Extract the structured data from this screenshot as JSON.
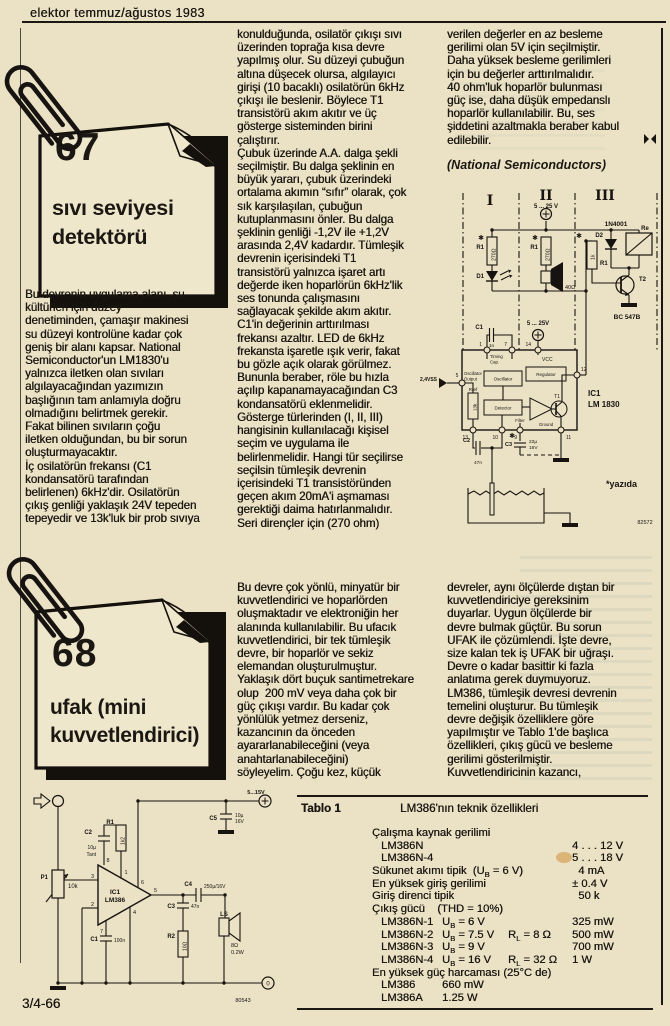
{
  "header": {
    "title": "elektor temmuz/ağustos 1983"
  },
  "footer": {
    "page_number": "3/4-66"
  },
  "article67": {
    "number": "67",
    "title": "sıvı seviyesi\ndetektörü",
    "col1": "Bu devrenin uygulama alanı, su\nkültürleri için düzey\ndenetiminden, çamaşır makinesi\nsu düzeyi kontrolüne kadar çok\ngeniş bir alanı kapsar. National\nSemiconductor'un LM1830'u\nyalnızca iletken olan sıvıları\nalgılayacağından yazımızın\nbaşlığının tam anlamıyla doğru\nolmadığını belirtmek gerekir.\nFakat bilinen sıvıların çoğu\niletken olduğundan, bu bir sorun\noluşturmayacaktır.\nİç osilatörün frekansı (C1\nkondansatörü tarafından\nbelirlenen) 6kHz'dir. Osilatörün\nçıkış genliği yaklaşık 24V tepeden\ntepeyedir ve 13k'luk bir prob sıvıya",
    "col2": "konulduğunda, osilatör çıkışı sıvı\nüzerinden toprağa kısa devre\nyapılmış olur. Su düzeyi çubuğun\naltına düşecek olursa, algılayıcı\ngirişi (10 bacaklı) osilatörün 6kHz\nçıkışı ile beslenir. Böylece T1\ntransistörü akım akıtır ve üç\ngösterge sisteminden birini\nçalıştırır.\nÇubuk üzerinde A.A. dalga şekli\nseçilmiştir. Bu dalga şeklinin en\nbüyük yararı, çubuk üzerindeki\nortalama akımın “sıfır” olarak, çok\nsık karşılaşılan, çubuğun\nkutuplanmasını önler. Bu dalga\nşeklinin genliği -1,2V ile +1,2V\narasında 2,4V kadardır. Tümleşik\ndevrenin içerisindeki T1\ntransistörü yalnızca işaret artı\ndeğerde iken hoparlörün 6kHz'lik\nses tonunda çalışmasını\nsağlayacak şekilde akım akıtır.\nC1'in değerinin arttırılması\nfrekansı azaltır. LED de 6kHz\nfrekansta işaretle ışık verir, fakat\nbu gözle açık olarak görülmez.\nBununla beraber, röle bu hızla\naçılıp kapanamayacağından C3\nkondansatörü eklenmelidir.\nGösterge türlerinden (I, II, III)\nhangisinin kullanılacağı kişisel\nseçim ve uygulama ile\nbelirlenmelidir. Hangi tür seçilirse\nseçilsin tümleşik devrenin\niçerisindeki T1 transistöründen\ngeçen akım 20mA'i aşmaması\ngerektiği daima hatırlanmalıdır.\nSeri dirençler için (270 ohm)",
    "col3": "verilen değerler en az besleme\ngerilimi olan 5V için seçilmiştir.\nDaha yüksek besleme gerilimleri\niçin bu değerler arttırılmalıdır.\n40 ohm'luk hoparlör bulunması\ngüç ise, daha düşük empedanslı\nhoparlör kullanılabilir. Bu, ses\nşiddetini azaltmakla beraber kabul\nedilebilir.",
    "credit": "(National Semiconductors)"
  },
  "article68": {
    "number": "68",
    "title": "ufak (mini\nkuvvetlendirici)",
    "col2": "Bu devre çok yönlü, minyatür bir\nkuvvetlendirici ve hoparlörden\noluşmaktadır ve elektroniğin her\nalanında kullanılabilir. Bu ufacık\nkuvvetlendirici, bir tek tümleşik\ndevre, bir hoparlör ve sekiz\nelemandan oluşturulmuştur.\nYaklaşık dört buçuk santimetrekare\nolup  200 mV veya daha çok bir\ngüç çıkışı vardır. Bu kadar çok\nyönlülük yetmez derseniz,\nkazancının da önceden\nayararlanabileceğini (veya\nanahtarlanabileceğini)\nsöyleyelim. Çoğu kez, küçük",
    "col3": "devreler, aynı ölçülerde dıştan bir\nkuvvetlendiriciye gereksinim\nduyarlar. Uygun ölçülerde bir\ndevre bulmak güçtür. Bu sorun\nUFAK ile çözümlendi. İşte devre,\nsize kalan tek iş UFAK bir uğraşı.\nDevre o kadar basittir ki fazla\nanlatıma gerek duymuyoruz.\nLM386, tümleşik devresi devrenin\ntemelini oluşturur. Bu tümleşik\ndevre değişik özelliklere göre\nyapılmıştır ve Tablo 1'de başlıca\nözellikleri, çıkış gücü ve besleme\ngerilimi gösterilmiştir.\nKuvvetlendiricinin kazancı,"
  },
  "table": {
    "label": "Tablo 1",
    "title": "LM386'nın teknik özellikleri",
    "rows": [
      {
        "name": "Çalışma kaynak gerilimi",
        "indent": 0
      },
      {
        "name": "LM386N",
        "indent": 1,
        "value": "4 . . . 12 V"
      },
      {
        "name": "LM386N-4",
        "indent": 1,
        "value": "5 . . . 18 V"
      },
      {
        "name": "Sükunet akımı tipik  (U_B = 6 V)",
        "indent": 0,
        "value": "  4 mA"
      },
      {
        "name": "En yüksek giriş gerilimi",
        "indent": 0,
        "value": "± 0.4 V"
      },
      {
        "name": "Giriş direnci tipik",
        "indent": 0,
        "value": "  50 k"
      },
      {
        "name": "Çıkış gücü    (THD = 10%)",
        "indent": 0
      },
      {
        "name": "LM386N-1",
        "indent": 1,
        "cond1": "U_B = 6 V",
        "value": "325 mW"
      },
      {
        "name": "LM386N-2",
        "indent": 1,
        "cond1": "U_B = 7.5 V",
        "cond2": "R_L = 8 Ω",
        "value": "500 mW"
      },
      {
        "name": "LM386N-3",
        "indent": 1,
        "cond1": "U_B = 9 V",
        "value": "700 mW"
      },
      {
        "name": "LM386N-4",
        "indent": 1,
        "cond1": "U_B = 16 V",
        "cond2": "R_L = 32 Ω",
        "value": "1 W"
      },
      {
        "name": "En yüksek güç harcaması (25°C de)",
        "indent": 0
      },
      {
        "name": "LM386",
        "indent": 1,
        "cond1": "660 mW"
      },
      {
        "name": "LM386A",
        "indent": 1,
        "cond1": "1.25 W"
      }
    ]
  },
  "c67": {
    "sec1": "I",
    "sec2": "II",
    "sec3": "III",
    "supply_top": "5 ... 25 V",
    "supply_mid": "5 ... 25V",
    "star": "✱",
    "r1": "R1",
    "r1a_val": "270Ω",
    "r1b_val": "270Ω",
    "r1c_val": "1k",
    "d1": "D1",
    "d2": "D2",
    "d2_type": "1N4001",
    "relay": "Re",
    "t2": "T2",
    "t2_type": "BC 547B",
    "spk_val": "40Ω",
    "c1": "C1",
    "c1_val": "1n",
    "vcc": "VCC",
    "p1": "1",
    "p5": "5",
    "p7": "7",
    "p9": "9",
    "p10": "10",
    "p11": "11",
    "p12": "12",
    "p13": "13",
    "p14": "14",
    "timing": "Timing",
    "cap": "Cap.",
    "osc": "Oscillator",
    "reg": "Regulator",
    "det": "Detector",
    "osc_out1": "Oscillator",
    "osc_out2": "Output",
    "filter": "Filter",
    "ground": "Ground",
    "t1": "T1",
    "rref": "Rref",
    "rref_val": "13k",
    "vss": "2,4VSS",
    "c2": "C2",
    "c2_val": "47n",
    "c3": "C3",
    "c3_val1": "22µ",
    "c3_val2": "16V",
    "ic_ref": "IC1",
    "ic_type": "LM 1830",
    "note": "*yazıda",
    "fig_no": "82572"
  },
  "c68": {
    "p_pot": "P1",
    "pot_val": "10k",
    "c1": "C1",
    "c1_val": "100n",
    "c2": "C2",
    "c2_val1": "10µ",
    "c2_val2": "Tant",
    "r1": "R1",
    "r1_val": "1k2",
    "r2": "R2",
    "r2_val": "10Ω",
    "c3": "C3",
    "c3_val": "47n",
    "c4": "C4",
    "c4_val": "250µ/16V",
    "c5": "C5",
    "c5_val1": "10µ",
    "c5_val2": "16V",
    "ls": "LS",
    "ls_val1": "8Ω",
    "ls_val2": "0.2W",
    "supply": "5...15V",
    "zero": "0",
    "pin1": "1",
    "pin2": "2",
    "pin3": "3",
    "pin4": "4",
    "pin5": "5",
    "pin6": "6",
    "pin7": "7",
    "pin8": "8",
    "ic_ref": "IC1",
    "ic_type": "LM386",
    "fig_no": "80543"
  }
}
